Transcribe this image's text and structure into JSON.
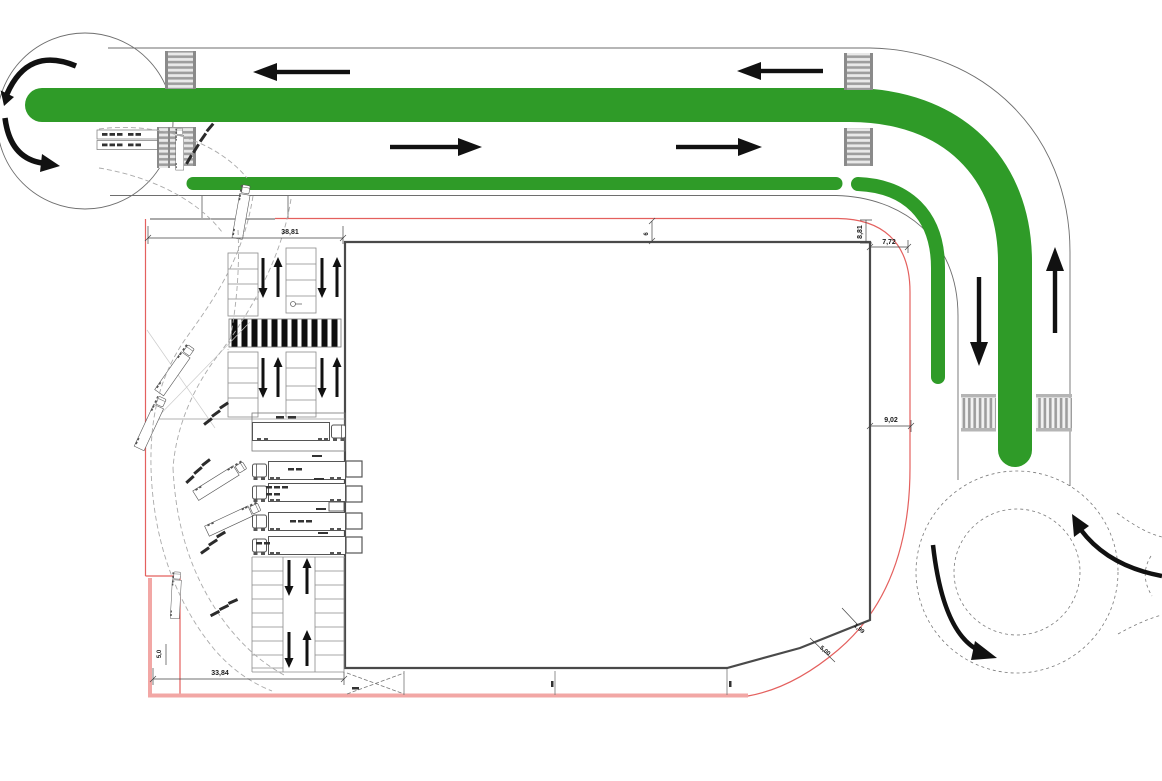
{
  "plan": {
    "dimensions": {
      "entry_width": "38,81",
      "corner_vertical": "8,81",
      "corner_horizontal": "7,72",
      "right_clearance": "9,02",
      "bottom_width": "33,84",
      "left_notch": "5,0",
      "chamfer_short": "1,99",
      "chamfer_long": "5,00",
      "building_setback": "6"
    },
    "colors": {
      "route_green": "#2F9B28",
      "boundary_red": "#E4605E",
      "boundary_pink": "#F2A7A5",
      "arrow_black": "#111111",
      "road_line": "#6E6E6E"
    }
  }
}
